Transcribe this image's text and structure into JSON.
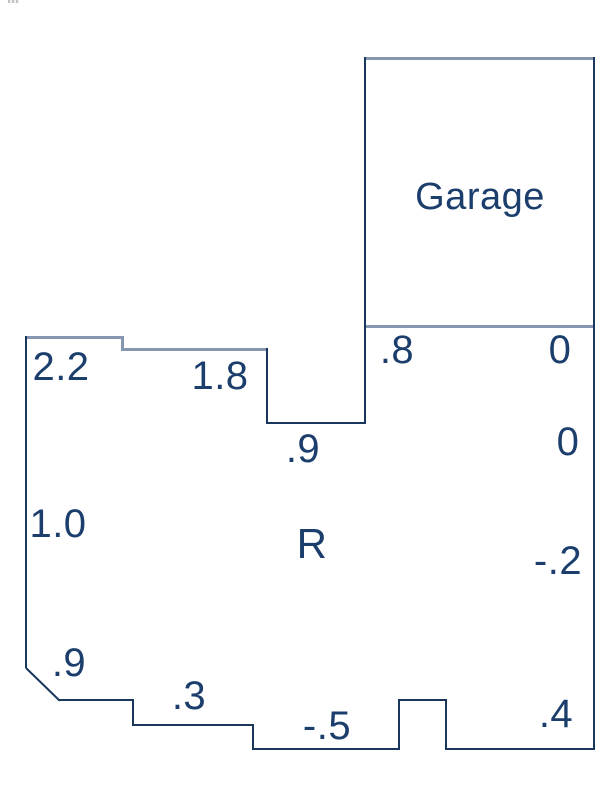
{
  "diagram": {
    "kind": "floor-plan-elevation-sketch",
    "canvas": {
      "width": 600,
      "height": 800,
      "background": "#ffffff"
    },
    "colors": {
      "outline_dark": "#17375d",
      "outline_light": "#8496b0",
      "text": "#1b3e6c"
    },
    "room_labels": {
      "garage": "Garage",
      "main": "R"
    },
    "labels": [
      {
        "id": "room-label-garage",
        "text": "Garage",
        "x": 480,
        "y": 197,
        "size": 38
      },
      {
        "id": "room-label-r",
        "text": "R",
        "x": 312,
        "y": 544,
        "size": 42
      },
      {
        "id": "spot-elev-2-2",
        "text": "2.2",
        "x": 61,
        "y": 367,
        "size": 40
      },
      {
        "id": "spot-elev-1-8",
        "text": "1.8",
        "x": 220,
        "y": 376,
        "size": 40
      },
      {
        "id": "spot-elev-dot8",
        "text": ".8",
        "x": 397,
        "y": 350,
        "size": 40
      },
      {
        "id": "spot-elev-0-upper",
        "text": "0",
        "x": 560,
        "y": 350,
        "size": 40
      },
      {
        "id": "spot-elev-dot9-step",
        "text": ".9",
        "x": 303,
        "y": 449,
        "size": 40
      },
      {
        "id": "spot-elev-0-lower",
        "text": "0",
        "x": 568,
        "y": 442,
        "size": 40
      },
      {
        "id": "spot-elev-1-0",
        "text": "1.0",
        "x": 58,
        "y": 524,
        "size": 40
      },
      {
        "id": "spot-elev-neg-dot2",
        "text": "-.2",
        "x": 558,
        "y": 561,
        "size": 40
      },
      {
        "id": "spot-elev-dot9-corner",
        "text": ".9",
        "x": 69,
        "y": 663,
        "size": 40
      },
      {
        "id": "spot-elev-dot3",
        "text": ".3",
        "x": 189,
        "y": 696,
        "size": 40
      },
      {
        "id": "spot-elev-neg-dot5",
        "text": "-.5",
        "x": 327,
        "y": 726,
        "size": 40
      },
      {
        "id": "spot-elev-dot4",
        "text": ".4",
        "x": 556,
        "y": 714,
        "size": 40
      }
    ],
    "lines": [
      {
        "id": "garage-top",
        "x1": 364,
        "y1": 57,
        "x2": 595,
        "y2": 57,
        "c": "light"
      },
      {
        "id": "garage-bottom",
        "x1": 364,
        "y1": 325,
        "x2": 595,
        "y2": 325,
        "c": "light"
      },
      {
        "id": "garage-left",
        "x1": 364,
        "y1": 57,
        "x2": 364,
        "y2": 424,
        "c": "dark"
      },
      {
        "id": "right-edge",
        "x1": 593,
        "y1": 57,
        "x2": 593,
        "y2": 750,
        "c": "dark"
      },
      {
        "id": "top-edge-1",
        "x1": 25,
        "y1": 336,
        "x2": 123,
        "y2": 336,
        "c": "light"
      },
      {
        "id": "top-step",
        "x1": 121,
        "y1": 336,
        "x2": 121,
        "y2": 350,
        "c": "light"
      },
      {
        "id": "top-edge-2",
        "x1": 121,
        "y1": 348,
        "x2": 268,
        "y2": 348,
        "c": "light"
      },
      {
        "id": "notch-left",
        "x1": 266,
        "y1": 348,
        "x2": 266,
        "y2": 424,
        "c": "dark"
      },
      {
        "id": "notch-bottom",
        "x1": 266,
        "y1": 422,
        "x2": 365,
        "y2": 422,
        "c": "dark"
      },
      {
        "id": "left-edge",
        "x1": 25,
        "y1": 336,
        "x2": 25,
        "y2": 668,
        "c": "dark"
      },
      {
        "id": "corner-diagonal",
        "x1": 26,
        "y1": 667,
        "x2": 60,
        "y2": 700,
        "c": "dark",
        "diag": true
      },
      {
        "id": "bottom-step-1",
        "x1": 59,
        "y1": 699,
        "x2": 134,
        "y2": 699,
        "c": "dark"
      },
      {
        "id": "bottom-drop-1",
        "x1": 132,
        "y1": 699,
        "x2": 132,
        "y2": 726,
        "c": "dark"
      },
      {
        "id": "bottom-step-2",
        "x1": 132,
        "y1": 724,
        "x2": 254,
        "y2": 724,
        "c": "dark"
      },
      {
        "id": "bottom-drop-2",
        "x1": 252,
        "y1": 724,
        "x2": 252,
        "y2": 750,
        "c": "dark"
      },
      {
        "id": "bottom-edge-1",
        "x1": 252,
        "y1": 748,
        "x2": 400,
        "y2": 748,
        "c": "dark"
      },
      {
        "id": "bump-left",
        "x1": 398,
        "y1": 699,
        "x2": 398,
        "y2": 750,
        "c": "dark"
      },
      {
        "id": "bump-top",
        "x1": 398,
        "y1": 699,
        "x2": 447,
        "y2": 699,
        "c": "dark"
      },
      {
        "id": "bump-right",
        "x1": 445,
        "y1": 699,
        "x2": 445,
        "y2": 750,
        "c": "dark"
      },
      {
        "id": "bottom-edge-2",
        "x1": 445,
        "y1": 748,
        "x2": 595,
        "y2": 748,
        "c": "dark"
      }
    ]
  }
}
